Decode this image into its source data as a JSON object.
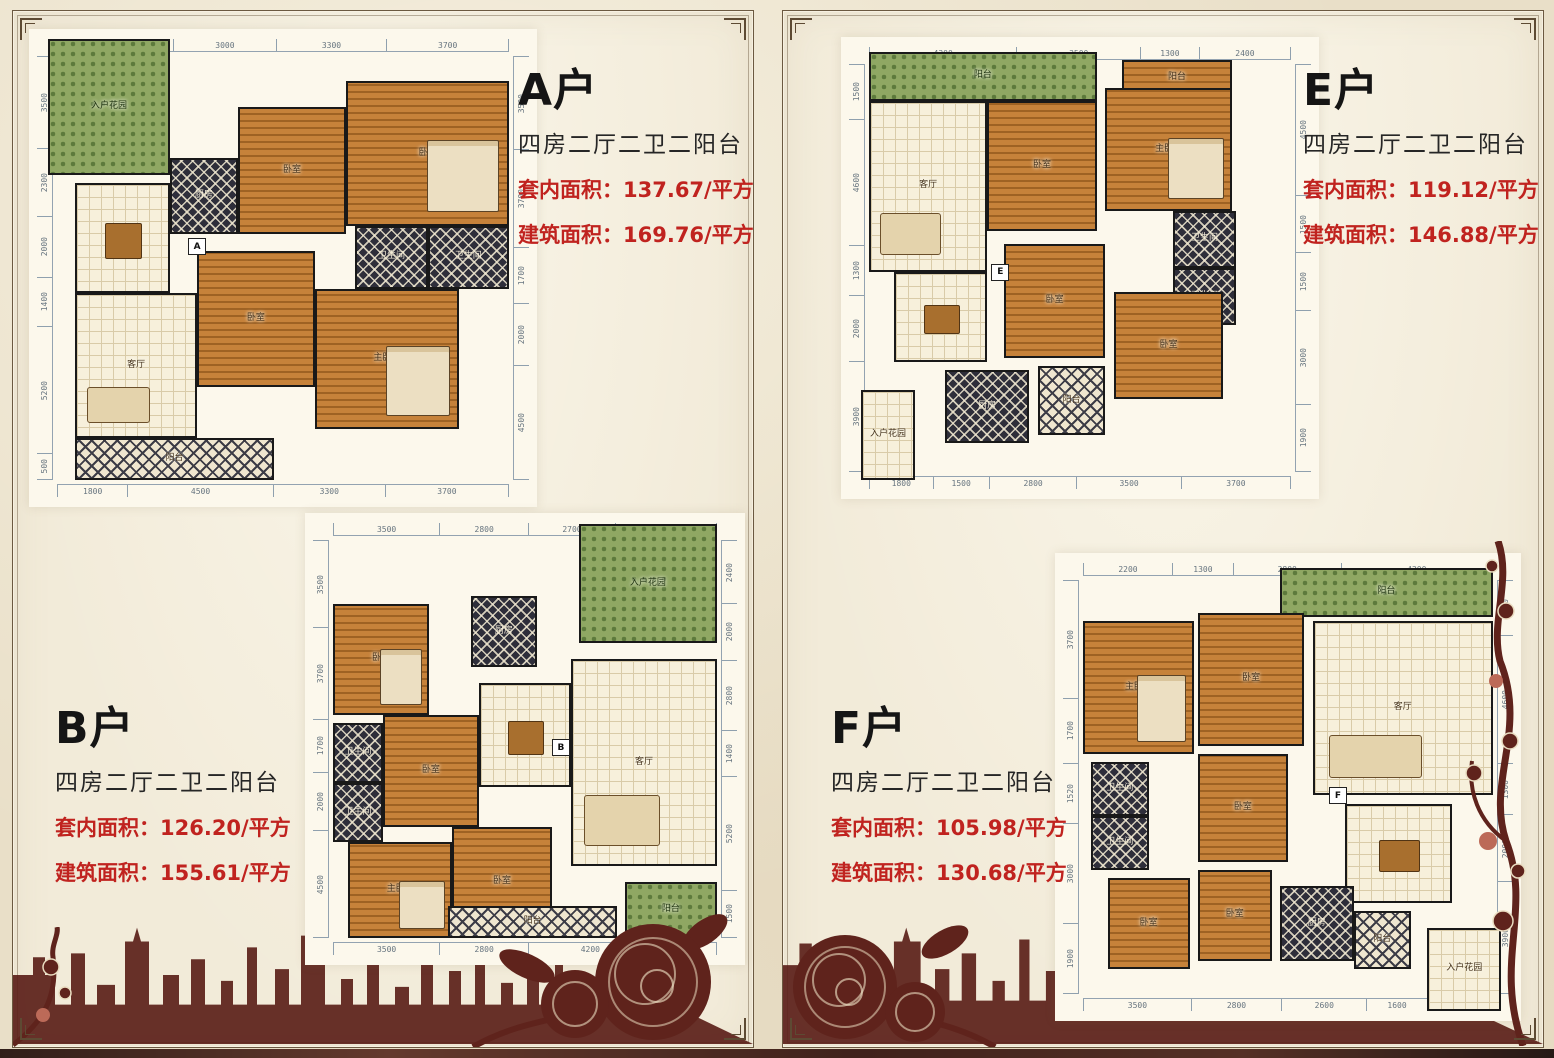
{
  "palette": {
    "paper": "#e9dfc8",
    "panel_paper": "#f2ebd9",
    "accent_red": "#c0231f",
    "ink": "#1d1d1d",
    "dim_text": "#66747f",
    "wall": "#191919",
    "wood_floor": "#bc7a33",
    "silhouette_maroon": "#5d2118"
  },
  "units": [
    {
      "title": "A户",
      "marker": "A",
      "subtitle": "四房二厅二卫二阳台",
      "area1_label": "套内面积：",
      "area1_value": "137.67/平方",
      "area2_label": "建筑面积：",
      "area2_value": "169.76/平方",
      "dims": {
        "top": [
          "3500",
          "3000",
          "3300",
          "3700"
        ],
        "bottom": [
          "1800",
          "4500",
          "3300",
          "3700"
        ],
        "left": [
          "3500",
          "2300",
          "2000",
          "1400",
          "5200",
          "500"
        ],
        "right": [
          "3500",
          "3700",
          "1700",
          "2000",
          "4500"
        ]
      },
      "rooms": {
        "entry": "入户花园",
        "living": "客厅",
        "dining": "餐厅",
        "kitchen": "厨房",
        "bed": "卧室",
        "master": "主卧室",
        "bath": "卫生间",
        "balcony": "阳台"
      }
    },
    {
      "title": "B户",
      "marker": "B",
      "subtitle": "四房二厅二卫二阳台",
      "area1_label": "套内面积：",
      "area1_value": "126.20/平方",
      "area2_label": "建筑面积：",
      "area2_value": "155.61/平方",
      "dims": {
        "top": [
          "3500",
          "2800",
          "2700",
          "3300"
        ],
        "bottom": [
          "3500",
          "2800",
          "4200",
          "1800"
        ],
        "left": [
          "3500",
          "3700",
          "1700",
          "2000",
          "4500"
        ],
        "right": [
          "2400",
          "2000",
          "2800",
          "1400",
          "5200",
          "1500"
        ]
      },
      "rooms": {
        "entry": "入户花园",
        "living": "客厅",
        "dining": "餐厅",
        "kitchen": "厨房",
        "bed": "卧室",
        "master": "主卧室",
        "bath": "卫生间",
        "balcony": "阳台"
      }
    },
    {
      "title": "E户",
      "marker": "E",
      "subtitle": "四房二厅二卫二阳台",
      "area1_label": "套内面积：",
      "area1_value": "119.12/平方",
      "area2_label": "建筑面积：",
      "area2_value": "146.88/平方",
      "dims": {
        "top": [
          "4300",
          "3500",
          "1300",
          "2400"
        ],
        "bottom": [
          "1800",
          "1500",
          "2800",
          "3500",
          "3700"
        ],
        "left": [
          "1500",
          "4600",
          "1300",
          "2000",
          "3900"
        ],
        "right": [
          "4500",
          "1500",
          "1500",
          "3000",
          "1900"
        ]
      },
      "rooms": {
        "entry": "入户花园",
        "living": "客厅",
        "dining": "餐厅",
        "kitchen": "厨房",
        "bed": "卧室",
        "master": "主卧室",
        "bath": "卫生间",
        "balcony": "阳台"
      }
    },
    {
      "title": "F户",
      "marker": "F",
      "subtitle": "四房二厅二卫二阳台",
      "area1_label": "套内面积：",
      "area1_value": "105.98/平方",
      "area2_label": "建筑面积：",
      "area2_value": "130.68/平方",
      "dims": {
        "top": [
          "2200",
          "1300",
          "2800",
          "4200"
        ],
        "bottom": [
          "3500",
          "2800",
          "2600",
          "1600",
          "1800"
        ],
        "left": [
          "3700",
          "1700",
          "1520",
          "3000",
          "1900"
        ],
        "right": [
          "1500",
          "4600",
          "1300",
          "2000",
          "3900"
        ]
      },
      "rooms": {
        "entry": "入户花园",
        "living": "客厅",
        "dining": "餐厅",
        "kitchen": "厨房",
        "bed": "卧室",
        "master": "主卧室",
        "bath": "卫生间",
        "balcony": "阳台"
      }
    }
  ]
}
